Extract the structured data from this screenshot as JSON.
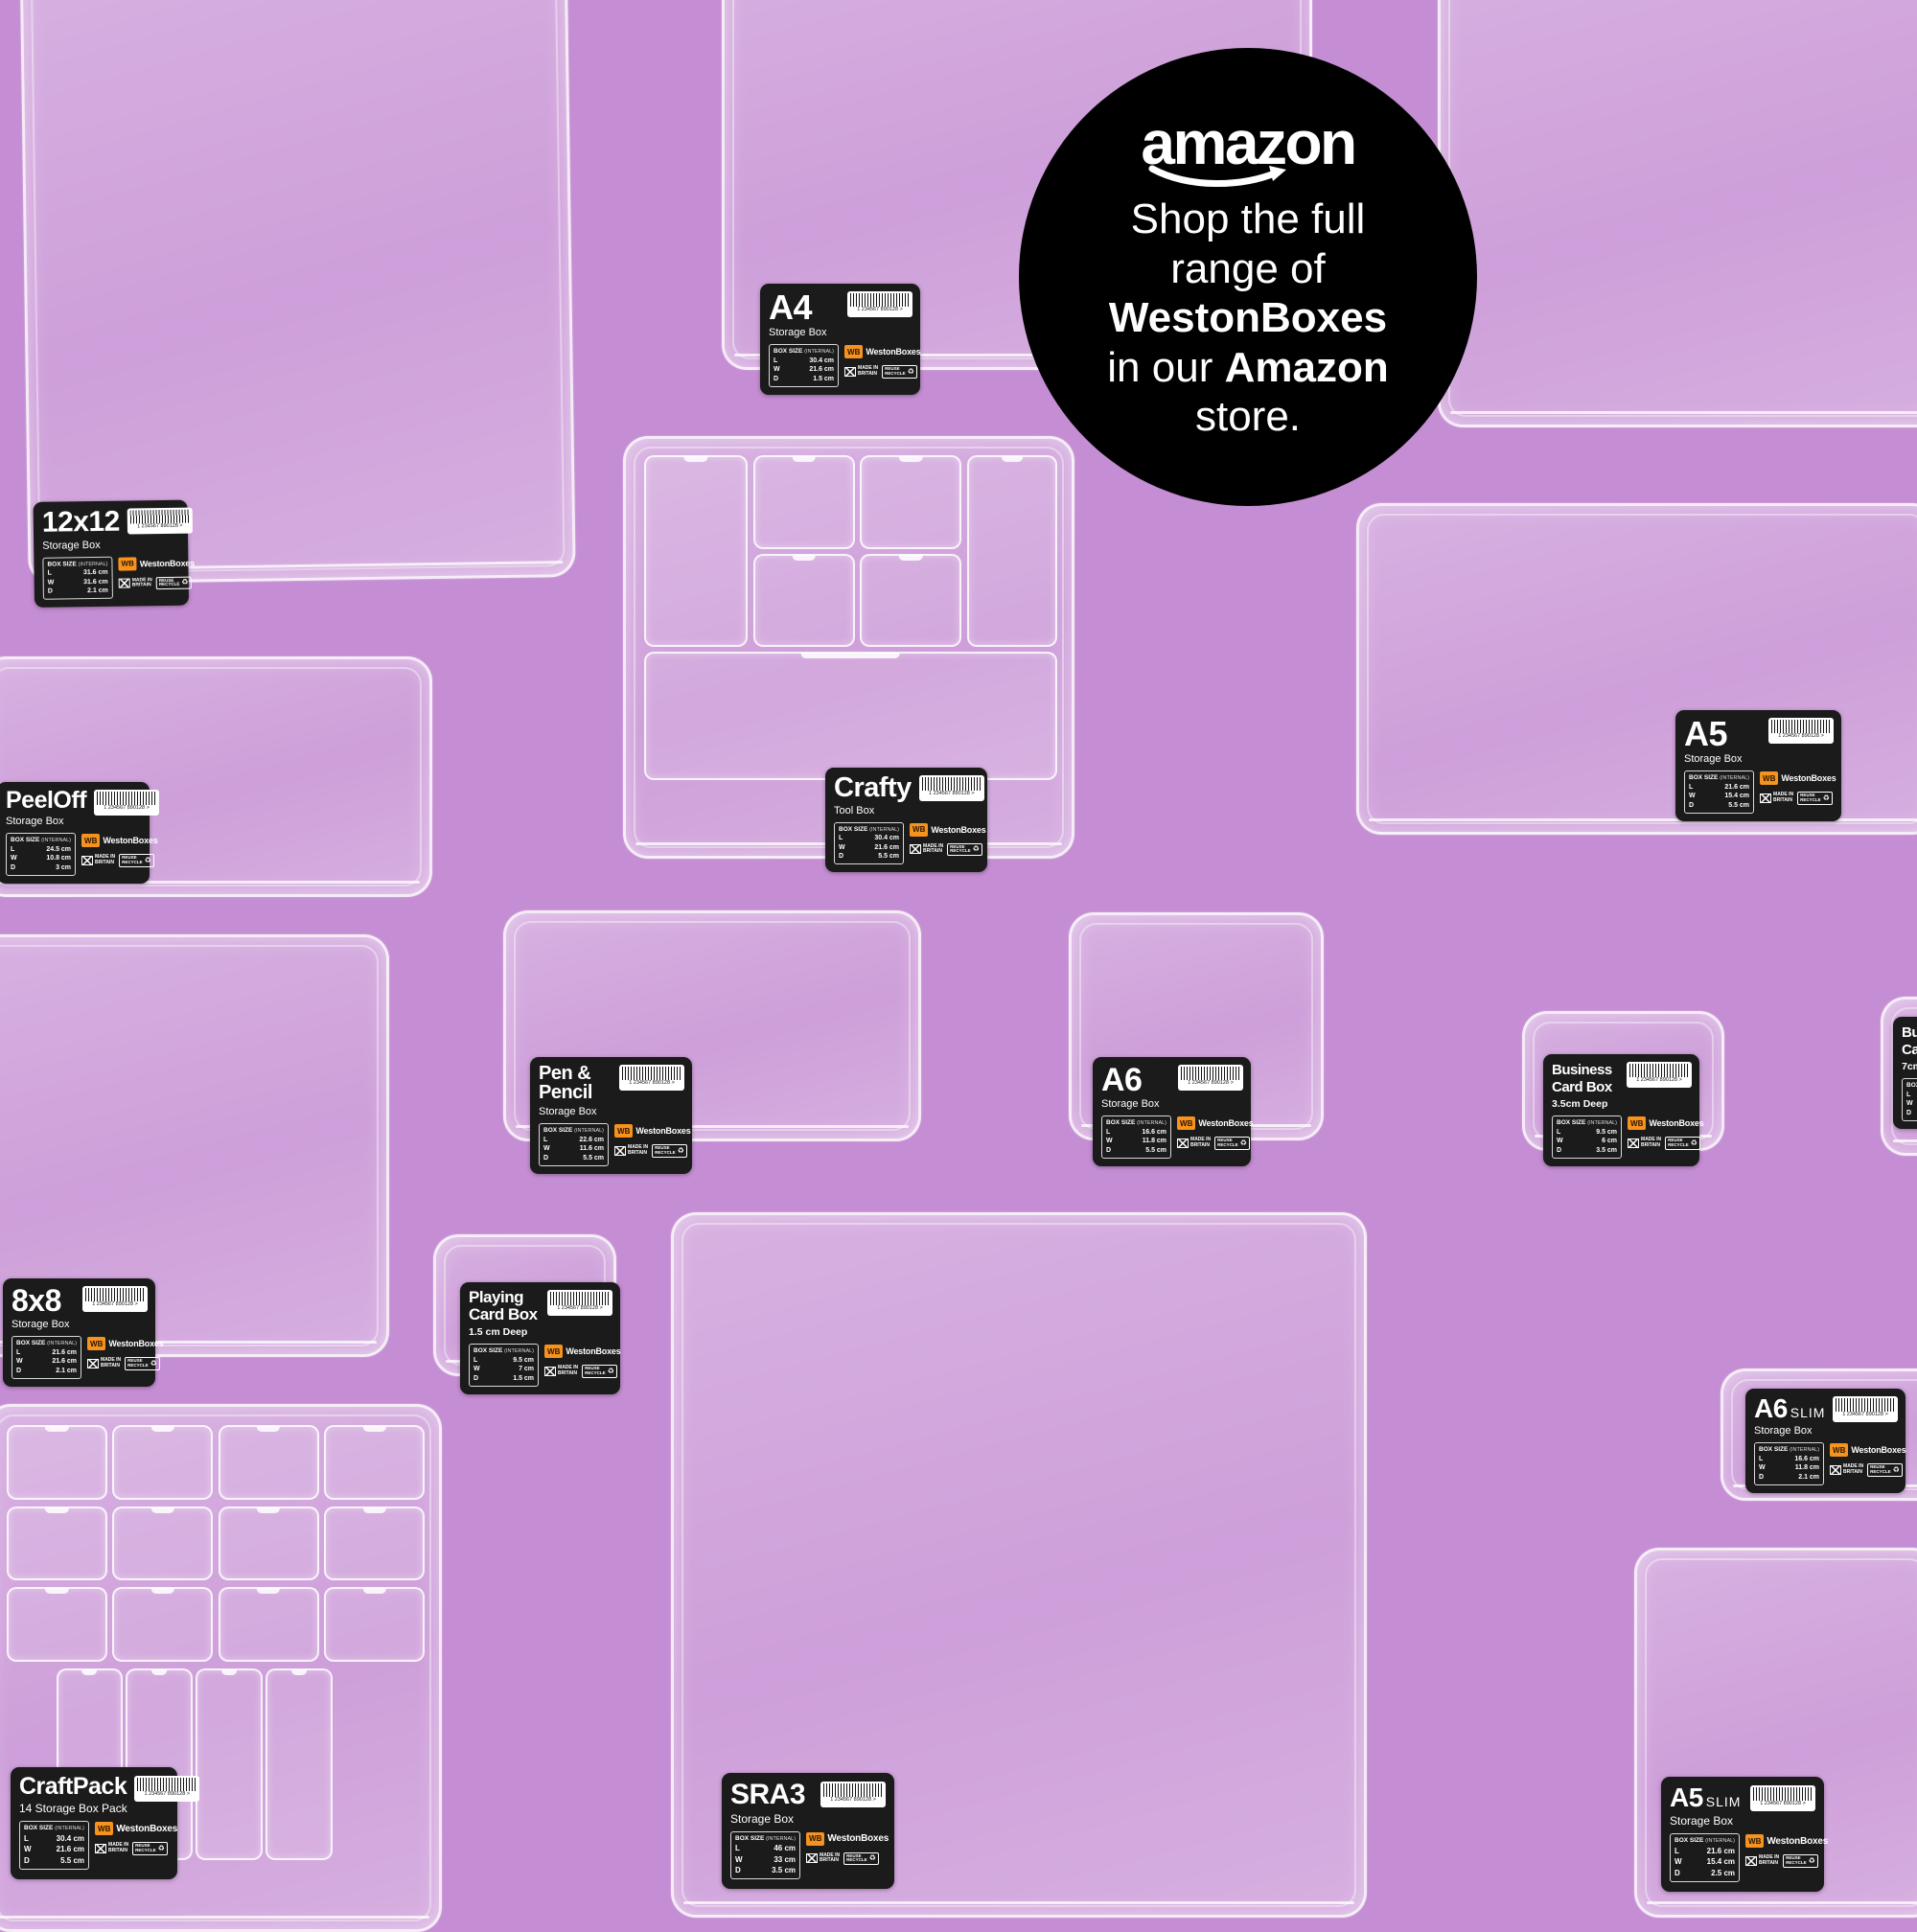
{
  "canvas": {
    "background_color": "#c58dd3",
    "label_background": "#1b1b1b",
    "brand_orange": "#f6921e"
  },
  "badge": {
    "logo_text": "amazon",
    "lines": [
      [
        {
          "t": "Shop the full",
          "b": 0
        }
      ],
      [
        {
          "t": "range of",
          "b": 0
        }
      ],
      [
        {
          "t": "WestonBoxes",
          "b": 1
        }
      ],
      [
        {
          "t": "in our ",
          "b": 0
        },
        {
          "t": "Amazon",
          "b": 1
        }
      ],
      [
        {
          "t": "store.",
          "b": 0
        }
      ]
    ]
  },
  "label_common": {
    "size_header": "BOX SIZE",
    "size_header_note": "(INTERNAL)",
    "dim_keys": [
      "L",
      "W",
      "D"
    ],
    "brand": "WestonBoxes",
    "brand_abbr": "WB",
    "made_in_line1": "MADE IN",
    "made_in_line2": "BRITAIN",
    "recycle_line1": "REUSE",
    "recycle_line2": "RECYCLE",
    "recycle_icon": "♻",
    "barcode_number": "1 234567 890128 >"
  },
  "boxes": [
    {
      "id": "b12x12",
      "title": "12x12",
      "suffix": "",
      "subtitle": "Storage Box",
      "note": "",
      "dims": {
        "l": "31.6 cm",
        "w": "31.6 cm",
        "d": "2.1 cm"
      },
      "show_label": true
    },
    {
      "id": "a4",
      "title": "A4",
      "suffix": "",
      "subtitle": "Storage Box",
      "note": "",
      "dims": {
        "l": "30.4 cm",
        "w": "21.6 cm",
        "d": "1.5 cm"
      },
      "show_label": true
    },
    {
      "id": "tr",
      "title": "",
      "suffix": "",
      "subtitle": "",
      "note": "",
      "show_label": false
    },
    {
      "id": "crafty",
      "title": "Crafty",
      "suffix": "",
      "subtitle": "Tool Box",
      "note": "",
      "dims": {
        "l": "30.4 cm",
        "w": "21.6 cm",
        "d": "5.5 cm"
      },
      "show_label": true,
      "compartments": [
        {
          "x": 4,
          "y": 4,
          "w": 22.5,
          "h": 45
        },
        {
          "x": 28.5,
          "y": 4,
          "w": 22,
          "h": 21.5
        },
        {
          "x": 52.5,
          "y": 4,
          "w": 22,
          "h": 21.5
        },
        {
          "x": 76.5,
          "y": 4,
          "w": 19.5,
          "h": 45
        },
        {
          "x": 28.5,
          "y": 27.5,
          "w": 22,
          "h": 21.5
        },
        {
          "x": 52.5,
          "y": 27.5,
          "w": 22,
          "h": 21.5
        },
        {
          "x": 4,
          "y": 51,
          "w": 92,
          "h": 30
        }
      ]
    },
    {
      "id": "a5",
      "title": "A5",
      "suffix": "",
      "subtitle": "Storage Box",
      "note": "",
      "dims": {
        "l": "21.6 cm",
        "w": "15.4 cm",
        "d": "5.5 cm"
      },
      "show_label": true
    },
    {
      "id": "peeloff",
      "title": "PeelOff",
      "suffix": "",
      "subtitle": "Storage Box",
      "note": "",
      "dims": {
        "l": "24.5 cm",
        "w": "10.8 cm",
        "d": "3 cm"
      },
      "show_label": true
    },
    {
      "id": "penpencil",
      "title": "Pen & Pencil",
      "suffix": "",
      "subtitle": "Storage Box",
      "note": "",
      "dims": {
        "l": "22.6 cm",
        "w": "11.6 cm",
        "d": "5.5 cm"
      },
      "show_label": true
    },
    {
      "id": "a6",
      "title": "A6",
      "suffix": "",
      "subtitle": "Storage Box",
      "note": "",
      "dims": {
        "l": "16.6 cm",
        "w": "11.8 cm",
        "d": "5.5 cm"
      },
      "show_label": true
    },
    {
      "id": "biz35",
      "title": "Business Card Box",
      "suffix": "",
      "subtitle": "",
      "note": "3.5cm Deep",
      "dims": {
        "l": "9.5 cm",
        "w": "6 cm",
        "d": "3.5 cm"
      },
      "show_label": true
    },
    {
      "id": "biz7",
      "title": "Business Card Box",
      "suffix": "",
      "subtitle": "",
      "note": "7cm Deep",
      "dims": {
        "l": "9.5 cm",
        "w": "6 cm",
        "d": "7 cm"
      },
      "show_label": true
    },
    {
      "id": "b8x8",
      "title": "8x8",
      "suffix": "",
      "subtitle": "Storage Box",
      "note": "",
      "dims": {
        "l": "21.6 cm",
        "w": "21.6 cm",
        "d": "2.1 cm"
      },
      "show_label": true
    },
    {
      "id": "playing",
      "title": "Playing Card Box",
      "suffix": "",
      "subtitle": "",
      "note": "1.5 cm Deep",
      "dims": {
        "l": "9.5 cm",
        "w": "7 cm",
        "d": "1.5 cm"
      },
      "show_label": true
    },
    {
      "id": "sra3",
      "title": "SRA3",
      "suffix": "",
      "subtitle": "Storage Box",
      "note": "",
      "dims": {
        "l": "46 cm",
        "w": "33 cm",
        "d": "3.5 cm"
      },
      "show_label": true,
      "large_label": true
    },
    {
      "id": "a6slim",
      "title": "A6",
      "suffix": "SLIM",
      "subtitle": "Storage Box",
      "note": "",
      "dims": {
        "l": "16.6 cm",
        "w": "11.8 cm",
        "d": "2.1 cm"
      },
      "show_label": true
    },
    {
      "id": "a5slim",
      "title": "A5",
      "suffix": "SLIM",
      "subtitle": "Storage Box",
      "note": "",
      "dims": {
        "l": "21.6 cm",
        "w": "15.4 cm",
        "d": "2.5 cm"
      },
      "show_label": true,
      "large_label": true
    },
    {
      "id": "craftpack",
      "title": "CraftPack",
      "suffix": "",
      "subtitle": "14 Storage Box Pack",
      "note": "",
      "dims": {
        "l": "30.4 cm",
        "w": "21.6 cm",
        "d": "5.5 cm"
      },
      "show_label": true,
      "large_label": true,
      "compartments": [
        {
          "x": 4,
          "y": 3.5,
          "w": 21.5,
          "h": 13.5
        },
        {
          "x": 27.5,
          "y": 3.5,
          "w": 21.5,
          "h": 13.5
        },
        {
          "x": 51,
          "y": 3.5,
          "w": 21.5,
          "h": 13.5
        },
        {
          "x": 74.5,
          "y": 3.5,
          "w": 21.5,
          "h": 13.5
        },
        {
          "x": 4,
          "y": 19,
          "w": 21.5,
          "h": 13.5
        },
        {
          "x": 27.5,
          "y": 19,
          "w": 21.5,
          "h": 13.5
        },
        {
          "x": 51,
          "y": 19,
          "w": 21.5,
          "h": 13.5
        },
        {
          "x": 74.5,
          "y": 19,
          "w": 21.5,
          "h": 13.5
        },
        {
          "x": 4,
          "y": 34.5,
          "w": 21.5,
          "h": 13.5
        },
        {
          "x": 27.5,
          "y": 34.5,
          "w": 21.5,
          "h": 13.5
        },
        {
          "x": 51,
          "y": 34.5,
          "w": 21.5,
          "h": 13.5
        },
        {
          "x": 74.5,
          "y": 34.5,
          "w": 21.5,
          "h": 13.5
        },
        {
          "x": 15,
          "y": 50,
          "w": 14,
          "h": 36
        },
        {
          "x": 30.5,
          "y": 50,
          "w": 14,
          "h": 36
        },
        {
          "x": 46,
          "y": 50,
          "w": 14,
          "h": 36
        },
        {
          "x": 61.5,
          "y": 50,
          "w": 14,
          "h": 36
        }
      ]
    }
  ]
}
